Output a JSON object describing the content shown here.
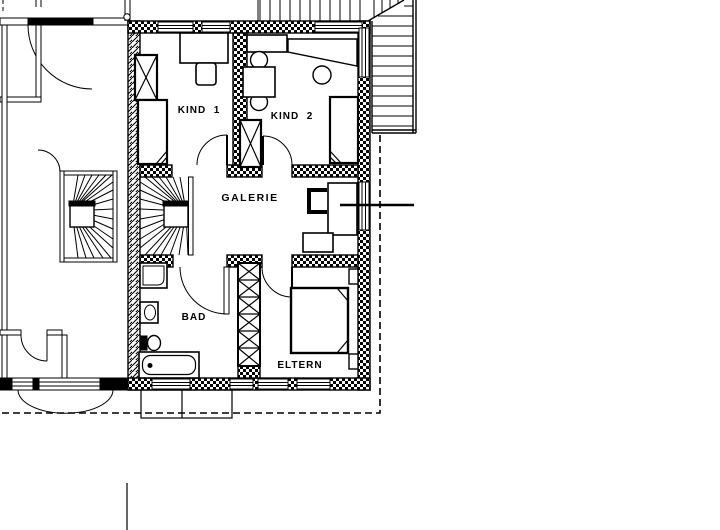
{
  "plan": {
    "rooms": {
      "kind1": "KIND  1",
      "kind2": "KIND  2",
      "galerie": "GALERIE",
      "bad": "BAD",
      "eltern": "ELTERN"
    },
    "colors": {
      "ink": "#000000",
      "paper": "#ffffff"
    }
  }
}
